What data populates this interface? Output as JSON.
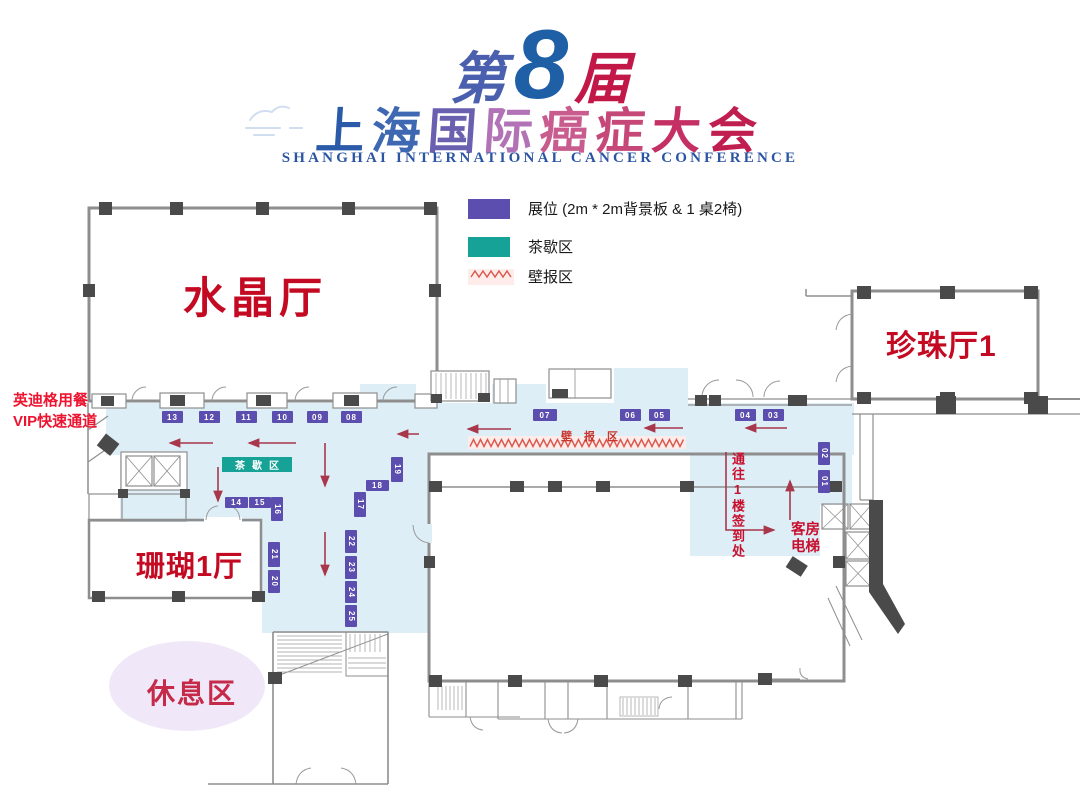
{
  "title": {
    "line1": {
      "prefix": "第",
      "number": "8",
      "suffix": "届"
    },
    "line2_chars": [
      "上",
      "海",
      "国",
      "际",
      "癌",
      "症",
      "大",
      "会"
    ],
    "line3": "SHANGHAI INTERNATIONAL CANCER CONFERENCE"
  },
  "legend": {
    "booth_label": "展位 (2m * 2m背景板 & 1 桌2椅)",
    "tea_label": "茶歇区",
    "poster_label": "壁报区"
  },
  "map": {
    "halls": {
      "crystal": "水晶厅",
      "pearl": "珍珠厅1",
      "coral": "珊瑚1厅",
      "rest": "休息区"
    },
    "labels": {
      "vip": "英迪格用餐\nVIP快速通道",
      "tea_area": "茶歇区",
      "poster_area": "壁报区",
      "route_sign": "通往1楼签到处",
      "elevator": "客房\n电梯"
    },
    "booths": [
      {
        "id": "13",
        "x": 162,
        "y": 411,
        "o": "h"
      },
      {
        "id": "12",
        "x": 199,
        "y": 411,
        "o": "h"
      },
      {
        "id": "11",
        "x": 236,
        "y": 411,
        "o": "h"
      },
      {
        "id": "10",
        "x": 272,
        "y": 411,
        "o": "h"
      },
      {
        "id": "09",
        "x": 307,
        "y": 411,
        "o": "h"
      },
      {
        "id": "08",
        "x": 341,
        "y": 411,
        "o": "h"
      },
      {
        "id": "07",
        "x": 533,
        "y": 409,
        "o": "h",
        "w": 24
      },
      {
        "id": "06",
        "x": 620,
        "y": 409,
        "o": "h"
      },
      {
        "id": "05",
        "x": 649,
        "y": 409,
        "o": "h"
      },
      {
        "id": "04",
        "x": 735,
        "y": 409,
        "o": "h"
      },
      {
        "id": "03",
        "x": 763,
        "y": 409,
        "o": "h"
      },
      {
        "id": "14",
        "x": 225,
        "y": 497,
        "o": "h",
        "w": 23,
        "h": 11
      },
      {
        "id": "15",
        "x": 249,
        "y": 497,
        "o": "h",
        "w": 22,
        "h": 11
      },
      {
        "id": "16",
        "x": 271,
        "y": 497,
        "o": "v",
        "h": 24
      },
      {
        "id": "17",
        "x": 354,
        "y": 492,
        "o": "v"
      },
      {
        "id": "18",
        "x": 366,
        "y": 480,
        "o": "h",
        "w": 23,
        "h": 11
      },
      {
        "id": "19",
        "x": 391,
        "y": 457,
        "o": "v"
      },
      {
        "id": "21",
        "x": 268,
        "y": 542,
        "o": "v"
      },
      {
        "id": "20",
        "x": 268,
        "y": 570,
        "o": "v",
        "h": 23
      },
      {
        "id": "22",
        "x": 345,
        "y": 530,
        "o": "v",
        "h": 23
      },
      {
        "id": "23",
        "x": 345,
        "y": 556,
        "o": "v",
        "h": 23
      },
      {
        "id": "24",
        "x": 345,
        "y": 581,
        "o": "v",
        "h": 22
      },
      {
        "id": "25",
        "x": 345,
        "y": 605,
        "o": "v",
        "h": 22
      },
      {
        "id": "02",
        "x": 818,
        "y": 442,
        "o": "v",
        "h": 23
      },
      {
        "id": "01",
        "x": 818,
        "y": 470,
        "o": "v",
        "h": 23
      }
    ]
  },
  "colors": {
    "booth_purple": "#5b4eae",
    "tea_teal": "#16a296",
    "poster_band_pink": "#fdecea",
    "poster_zigzag_red": "#d9574d",
    "corridor_blue": "#ddeef7",
    "hall_label_red": "#c40a22",
    "arrow_red": "#a8374b",
    "vip_red": "#ed1430",
    "title_blue": "#2b5aa8",
    "title_crimson": "#c11848",
    "rest_lavender": "#f0e8f8"
  }
}
